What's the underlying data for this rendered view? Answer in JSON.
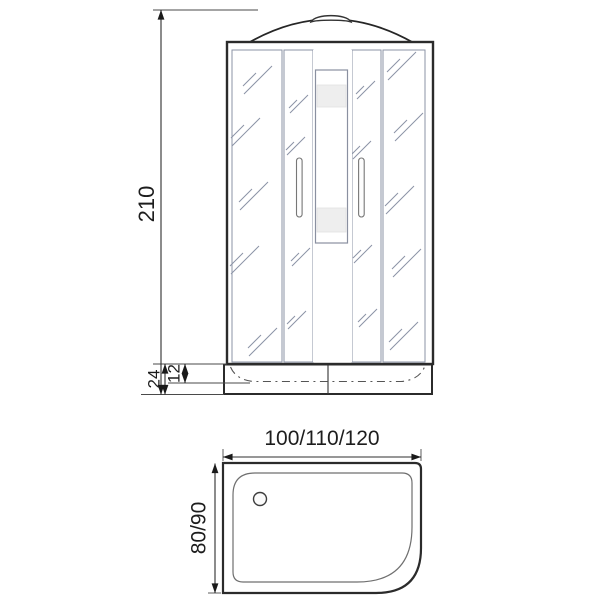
{
  "drawing": {
    "type": "shower-cabin-dimension-diagram",
    "views": {
      "front_elevation": {
        "overall_height_label": "210",
        "tray_height_label": "24",
        "tray_rim_height_label": "12"
      },
      "plan_view": {
        "width_options_label": "100/110/120",
        "depth_options_label": "80/90"
      }
    },
    "colors": {
      "line": "#2b2b2b",
      "dimension_line": "#2f2f2f",
      "glass_fill": "#e9edf8",
      "hatch": "#8b93a6",
      "shelf_band": "#eeeeee",
      "background": "#ffffff"
    }
  }
}
